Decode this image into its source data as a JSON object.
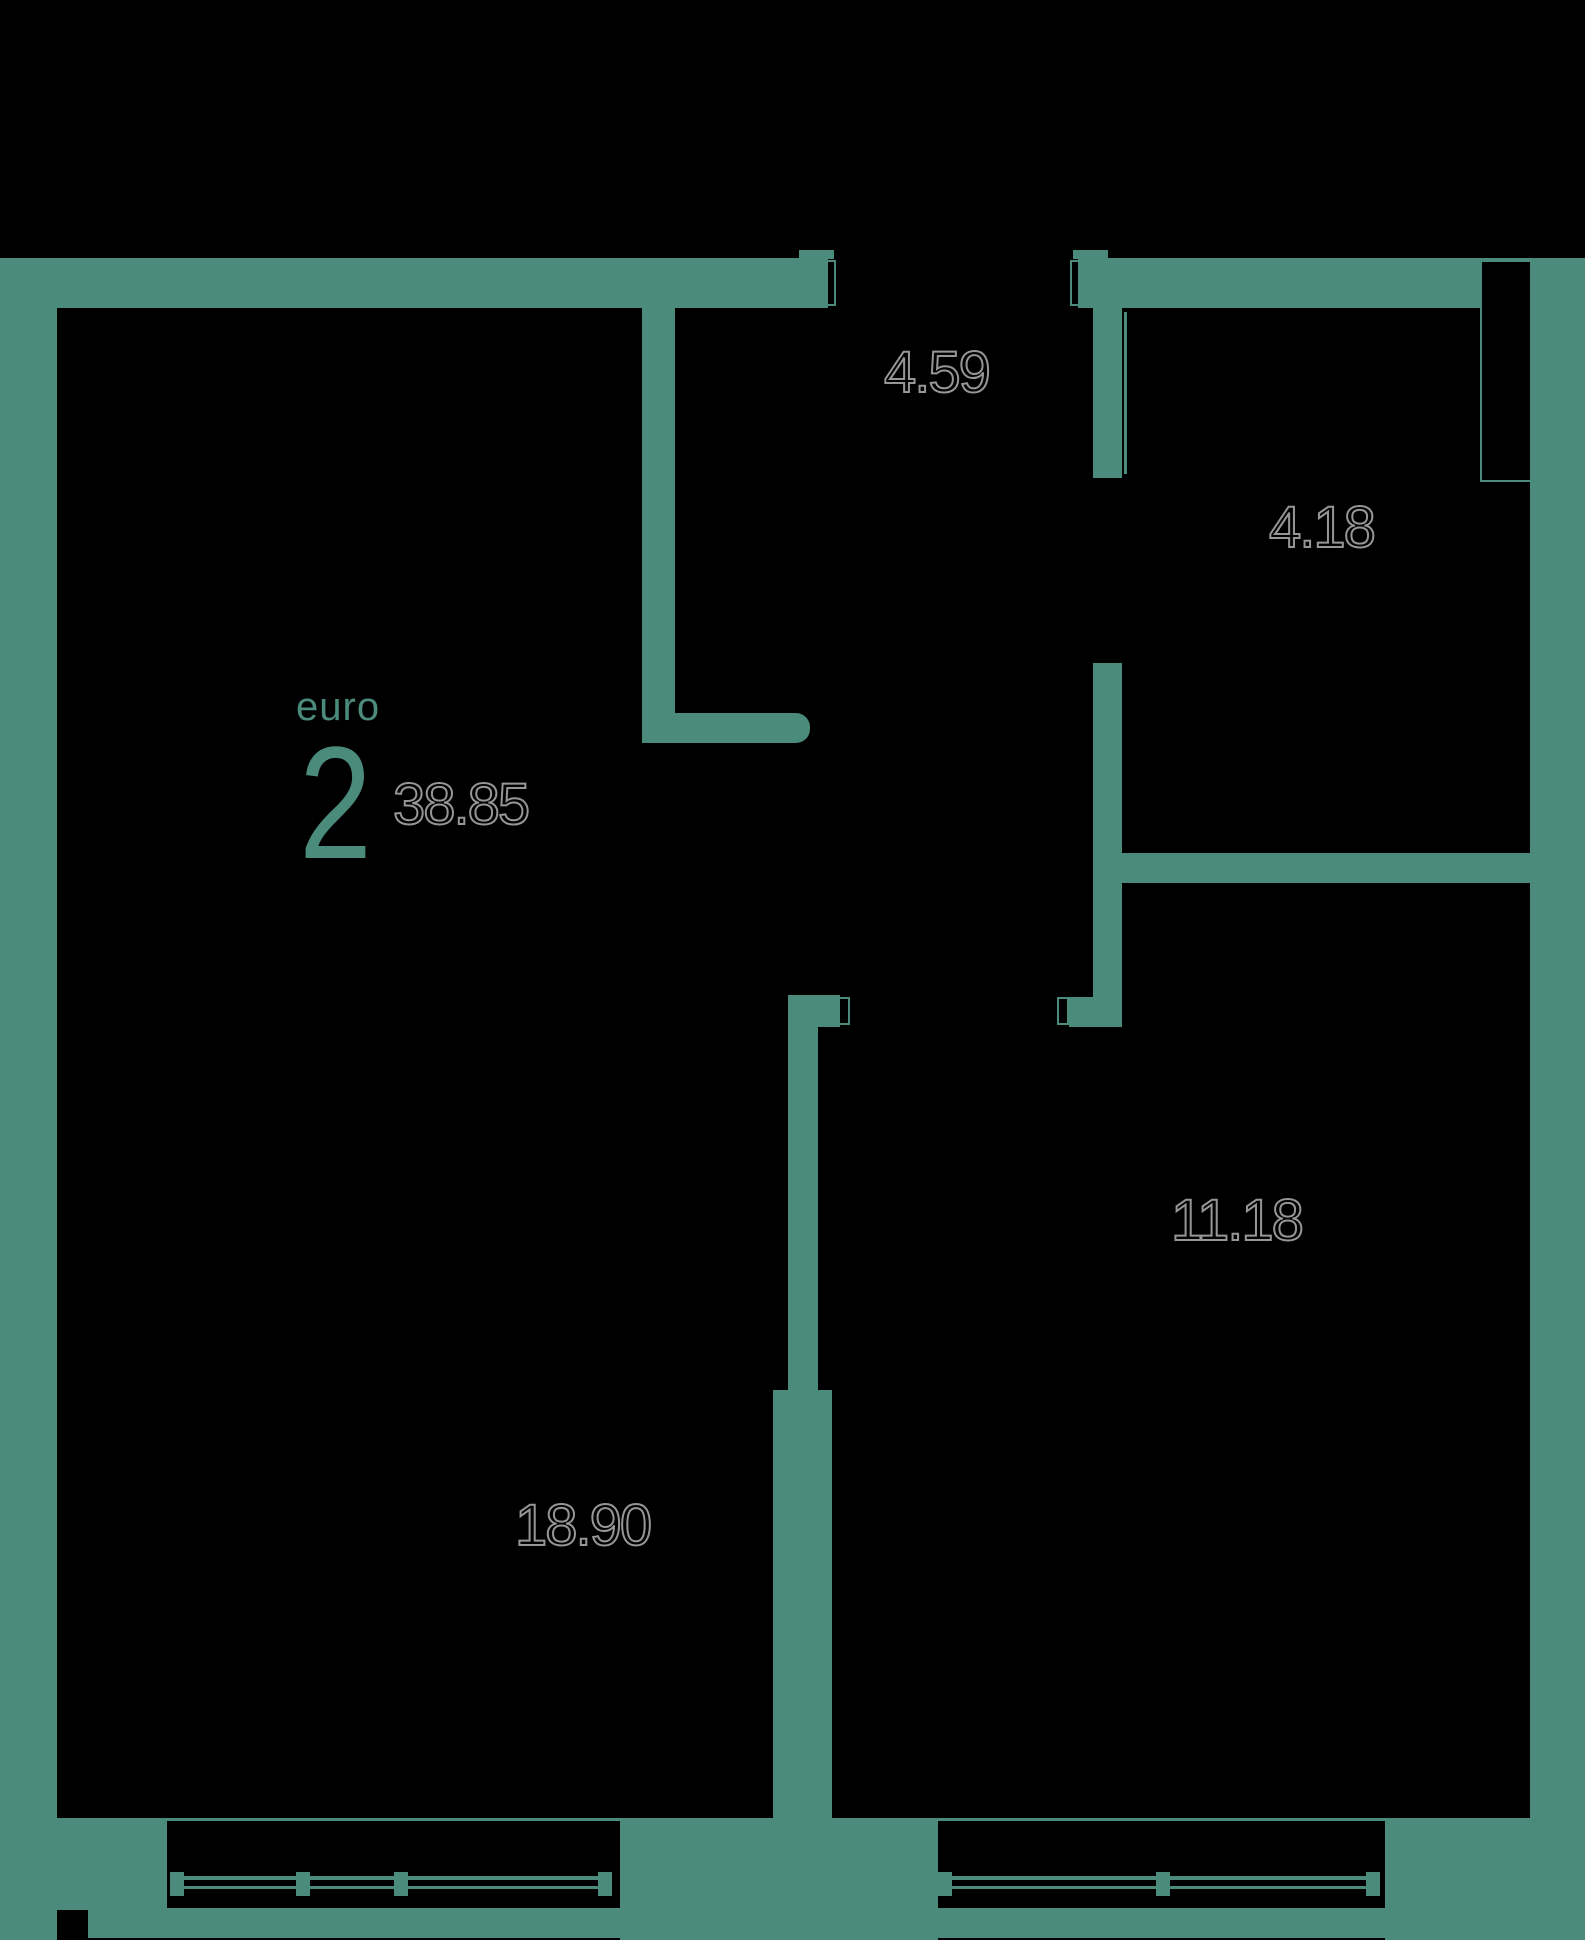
{
  "floorplan": {
    "unit": {
      "type_label": "euro",
      "rooms_count": "2",
      "total_area": "38.85"
    },
    "room_areas": {
      "hallway": "4.59",
      "bathroom": "4.18",
      "bedroom": "11.18",
      "living_kitchen": "18.90"
    },
    "colors": {
      "walls": "#4A8B7B",
      "background": "#000000",
      "area_number_fill": "#000000",
      "area_number_outline": "#969696"
    }
  }
}
